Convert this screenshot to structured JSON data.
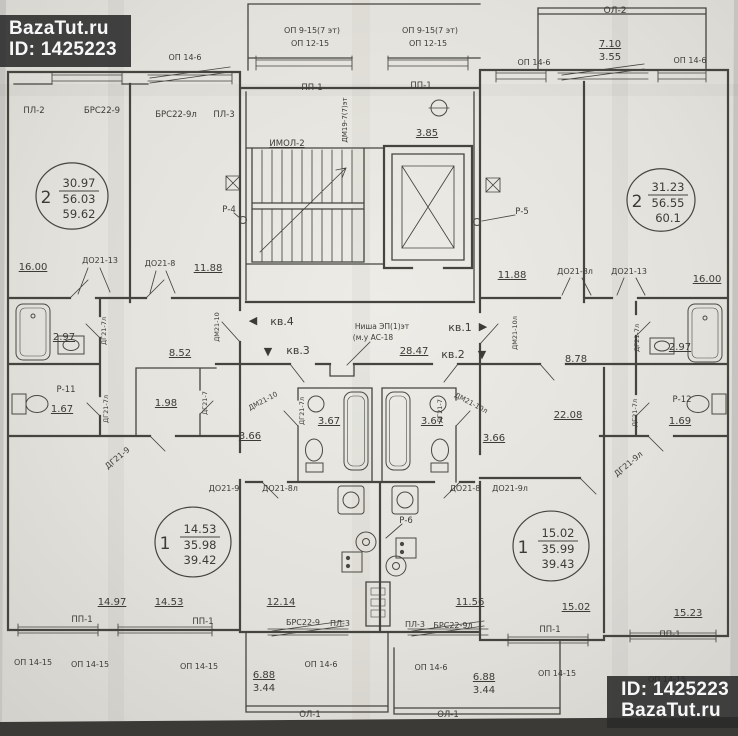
{
  "watermarks": {
    "top_left": {
      "line1": "BazaTut.ru",
      "line2": "ID: 1425223"
    },
    "bottom_right": {
      "line1": "ID: 1425223",
      "line2": "BazaTut.ru"
    }
  },
  "plan": {
    "stamps": [
      {
        "rooms": "2",
        "area_living": "30.97",
        "area_usable": "56.03",
        "area_total": "59.62",
        "cx": 72,
        "cy": 196,
        "r": 36
      },
      {
        "rooms": "2",
        "area_living": "31.23",
        "area_usable": "56.55",
        "area_total": "60.1",
        "cx": 661,
        "cy": 200,
        "r": 34
      },
      {
        "rooms": "1",
        "area_living": "14.53",
        "area_usable": "35.98",
        "area_total": "39.42",
        "cx": 193,
        "cy": 542,
        "r": 38
      },
      {
        "rooms": "1",
        "area_living": "15.02",
        "area_usable": "35.99",
        "area_total": "39.43",
        "cx": 551,
        "cy": 546,
        "r": 38
      }
    ],
    "labels": [
      {
        "t": "ОП 9-15(7 эт)",
        "x": 312,
        "y": 33,
        "s": 8
      },
      {
        "t": "ОП 12-15",
        "x": 310,
        "y": 46,
        "s": 8
      },
      {
        "t": "ОП 9-15(7 эт)",
        "x": 430,
        "y": 33,
        "s": 8
      },
      {
        "t": "ОП 12-15",
        "x": 428,
        "y": 46,
        "s": 8
      },
      {
        "t": "ОЛ-2",
        "x": 615,
        "y": 13,
        "s": 9
      },
      {
        "t": "7.10",
        "x": 610,
        "y": 47,
        "s": 10,
        "u": 1
      },
      {
        "t": "3.55",
        "x": 610,
        "y": 60,
        "s": 10
      },
      {
        "t": "ОП 14-6",
        "x": 185,
        "y": 60,
        "s": 8
      },
      {
        "t": "ОП 14-6",
        "x": 534,
        "y": 65,
        "s": 8
      },
      {
        "t": "ОП 14-6",
        "x": 690,
        "y": 63,
        "s": 8
      },
      {
        "t": "ПЛ-2",
        "x": 34,
        "y": 113,
        "s": 8.5
      },
      {
        "t": "БРС22-9",
        "x": 102,
        "y": 113,
        "s": 8.5
      },
      {
        "t": "БРС22-9л",
        "x": 176,
        "y": 117,
        "s": 8.5
      },
      {
        "t": "ПЛ-3",
        "x": 224,
        "y": 117,
        "s": 8.5
      },
      {
        "t": "ПП-1",
        "x": 312,
        "y": 90,
        "s": 8.5
      },
      {
        "t": "ПП-1",
        "x": 421,
        "y": 88,
        "s": 8.5
      },
      {
        "t": "ДМ19-7(7)эт",
        "x": 347,
        "y": 120,
        "s": 7,
        "r": -90
      },
      {
        "t": "3.85",
        "x": 427,
        "y": 136,
        "s": 10,
        "u": 1
      },
      {
        "t": "ИМОЛ-2",
        "x": 287,
        "y": 146,
        "s": 8.5,
        "u": 1
      },
      {
        "t": "Р-4",
        "x": 229,
        "y": 212,
        "s": 8.5
      },
      {
        "t": "Р-5",
        "x": 522,
        "y": 214,
        "s": 8.5
      },
      {
        "t": "16.00",
        "x": 33,
        "y": 270,
        "s": 10,
        "u": 1
      },
      {
        "t": "ДО21-13",
        "x": 100,
        "y": 263,
        "s": 8
      },
      {
        "t": "ДО21-8",
        "x": 160,
        "y": 266,
        "s": 8
      },
      {
        "t": "11.88",
        "x": 208,
        "y": 271,
        "s": 10,
        "u": 1
      },
      {
        "t": "11.88",
        "x": 512,
        "y": 278,
        "s": 10,
        "u": 1
      },
      {
        "t": "ДО21-8л",
        "x": 575,
        "y": 274,
        "s": 8
      },
      {
        "t": "ДО21-13",
        "x": 629,
        "y": 274,
        "s": 8
      },
      {
        "t": "16.00",
        "x": 707,
        "y": 282,
        "s": 10,
        "u": 1
      },
      {
        "t": "◀",
        "x": 253,
        "y": 324,
        "s": 11,
        "n": "direction-arrow"
      },
      {
        "t": "кв.4",
        "x": 282,
        "y": 325,
        "s": 11
      },
      {
        "t": "▼",
        "x": 268,
        "y": 355,
        "s": 11,
        "n": "direction-arrow"
      },
      {
        "t": "кв.3",
        "x": 298,
        "y": 354,
        "s": 11
      },
      {
        "t": "кв.1",
        "x": 460,
        "y": 331,
        "s": 11
      },
      {
        "t": "▶",
        "x": 483,
        "y": 330,
        "s": 11,
        "n": "direction-arrow"
      },
      {
        "t": "кв.2",
        "x": 453,
        "y": 358,
        "s": 11
      },
      {
        "t": "▼",
        "x": 482,
        "y": 358,
        "s": 11,
        "n": "direction-arrow"
      },
      {
        "t": "Ниша ЭП(1)эт",
        "x": 382,
        "y": 329,
        "s": 7.5
      },
      {
        "t": "(м.у АС-18",
        "x": 373,
        "y": 340,
        "s": 7.5
      },
      {
        "t": "28.47",
        "x": 414,
        "y": 354,
        "s": 10,
        "u": 1
      },
      {
        "t": "8.52",
        "x": 180,
        "y": 356,
        "s": 10,
        "u": 1
      },
      {
        "t": "8.78",
        "x": 576,
        "y": 362,
        "s": 10,
        "u": 1
      },
      {
        "t": "ДМ21-10",
        "x": 219,
        "y": 327,
        "s": 6.5,
        "r": -90
      },
      {
        "t": "ДМ21-10л",
        "x": 517,
        "y": 333,
        "s": 6.5,
        "r": -90
      },
      {
        "t": "2.97",
        "x": 64,
        "y": 340,
        "s": 10,
        "u": 1
      },
      {
        "t": "ДГ21-7л",
        "x": 106,
        "y": 331,
        "s": 6.5,
        "r": -90
      },
      {
        "t": "Р-11",
        "x": 66,
        "y": 392,
        "s": 8.5
      },
      {
        "t": "1.67",
        "x": 62,
        "y": 412,
        "s": 10,
        "u": 1
      },
      {
        "t": "ДГ21-7л",
        "x": 108,
        "y": 409,
        "s": 6.5,
        "r": -90
      },
      {
        "t": "ДГ21-9",
        "x": 119,
        "y": 460,
        "s": 8,
        "r": -40
      },
      {
        "t": "2.97",
        "x": 680,
        "y": 350,
        "s": 10,
        "u": 1
      },
      {
        "t": "ДГ21-7л",
        "x": 639,
        "y": 338,
        "s": 6.5,
        "r": -90
      },
      {
        "t": "Р-12",
        "x": 682,
        "y": 402,
        "s": 8.5
      },
      {
        "t": "1.69",
        "x": 680,
        "y": 424,
        "s": 10,
        "u": 1
      },
      {
        "t": "ДГ21-7л",
        "x": 637,
        "y": 413,
        "s": 6.5,
        "r": -90
      },
      {
        "t": "ДГ21-9л",
        "x": 630,
        "y": 466,
        "s": 8,
        "r": -40
      },
      {
        "t": "1.98",
        "x": 166,
        "y": 406,
        "s": 10,
        "u": 1
      },
      {
        "t": "ДГ21-7",
        "x": 207,
        "y": 403,
        "s": 6.5,
        "r": -90
      },
      {
        "t": "ДМ21-10",
        "x": 264,
        "y": 403,
        "s": 7,
        "r": -28
      },
      {
        "t": "3.66",
        "x": 250,
        "y": 439,
        "s": 10,
        "u": 1
      },
      {
        "t": "ДГ21-7л",
        "x": 304,
        "y": 411,
        "s": 6.5,
        "r": -90
      },
      {
        "t": "3.67",
        "x": 329,
        "y": 424,
        "s": 10,
        "u": 1
      },
      {
        "t": "3.67",
        "x": 432,
        "y": 424,
        "s": 10,
        "u": 1
      },
      {
        "t": "ДГ21-7",
        "x": 442,
        "y": 411,
        "s": 6.5,
        "r": -90
      },
      {
        "t": "ДМ21-10л",
        "x": 470,
        "y": 405,
        "s": 7,
        "r": 28
      },
      {
        "t": "3.66",
        "x": 494,
        "y": 441,
        "s": 10,
        "u": 1
      },
      {
        "t": "22.08",
        "x": 568,
        "y": 418,
        "s": 10,
        "u": 1
      },
      {
        "t": "ДО21-9",
        "x": 224,
        "y": 491,
        "s": 8
      },
      {
        "t": "ДО21-8л",
        "x": 280,
        "y": 491,
        "s": 8
      },
      {
        "t": "ДО21-8",
        "x": 465,
        "y": 491,
        "s": 8
      },
      {
        "t": "ДО21-9л",
        "x": 510,
        "y": 491,
        "s": 8
      },
      {
        "t": "Р-6",
        "x": 406,
        "y": 523,
        "s": 8.5
      },
      {
        "t": "14.97",
        "x": 112,
        "y": 605,
        "s": 10,
        "u": 1
      },
      {
        "t": "14.53",
        "x": 169,
        "y": 605,
        "s": 10,
        "u": 1
      },
      {
        "t": "12.14",
        "x": 281,
        "y": 605,
        "s": 10,
        "u": 1
      },
      {
        "t": "11.56",
        "x": 470,
        "y": 605,
        "s": 10,
        "u": 1
      },
      {
        "t": "15.02",
        "x": 576,
        "y": 610,
        "s": 10,
        "u": 1
      },
      {
        "t": "15.23",
        "x": 688,
        "y": 616,
        "s": 10,
        "u": 1
      },
      {
        "t": "ПП-1",
        "x": 82,
        "y": 622,
        "s": 8.5
      },
      {
        "t": "ПП-1",
        "x": 203,
        "y": 624,
        "s": 8.5
      },
      {
        "t": "ПП-1",
        "x": 550,
        "y": 632,
        "s": 8.5
      },
      {
        "t": "ПП-1",
        "x": 670,
        "y": 637,
        "s": 8.5
      },
      {
        "t": "БРС22-9",
        "x": 303,
        "y": 625,
        "s": 8
      },
      {
        "t": "ПЛ-3",
        "x": 340,
        "y": 626,
        "s": 8
      },
      {
        "t": "ПЛ-3",
        "x": 415,
        "y": 627,
        "s": 8
      },
      {
        "t": "БРС22-9л",
        "x": 453,
        "y": 628,
        "s": 8
      },
      {
        "t": "ОП 14-15",
        "x": 33,
        "y": 665,
        "s": 8
      },
      {
        "t": "ОП 14-15",
        "x": 90,
        "y": 667,
        "s": 8
      },
      {
        "t": "ОП 14-15",
        "x": 199,
        "y": 669,
        "s": 8
      },
      {
        "t": "ОП 14-6",
        "x": 321,
        "y": 667,
        "s": 8
      },
      {
        "t": "ОП 14-6",
        "x": 431,
        "y": 670,
        "s": 8
      },
      {
        "t": "ОП 14-15",
        "x": 557,
        "y": 676,
        "s": 8
      },
      {
        "t": "ОП 14-15",
        "x": 667,
        "y": 682,
        "s": 8
      },
      {
        "t": "6.88",
        "x": 264,
        "y": 678,
        "s": 10,
        "u": 1
      },
      {
        "t": "3.44",
        "x": 264,
        "y": 691,
        "s": 10
      },
      {
        "t": "6.88",
        "x": 484,
        "y": 680,
        "s": 10,
        "u": 1
      },
      {
        "t": "3.44",
        "x": 484,
        "y": 693,
        "s": 10
      },
      {
        "t": "ОЛ-1",
        "x": 310,
        "y": 717,
        "s": 8.5
      },
      {
        "t": "ОЛ-1",
        "x": 448,
        "y": 717,
        "s": 8.5
      }
    ]
  }
}
